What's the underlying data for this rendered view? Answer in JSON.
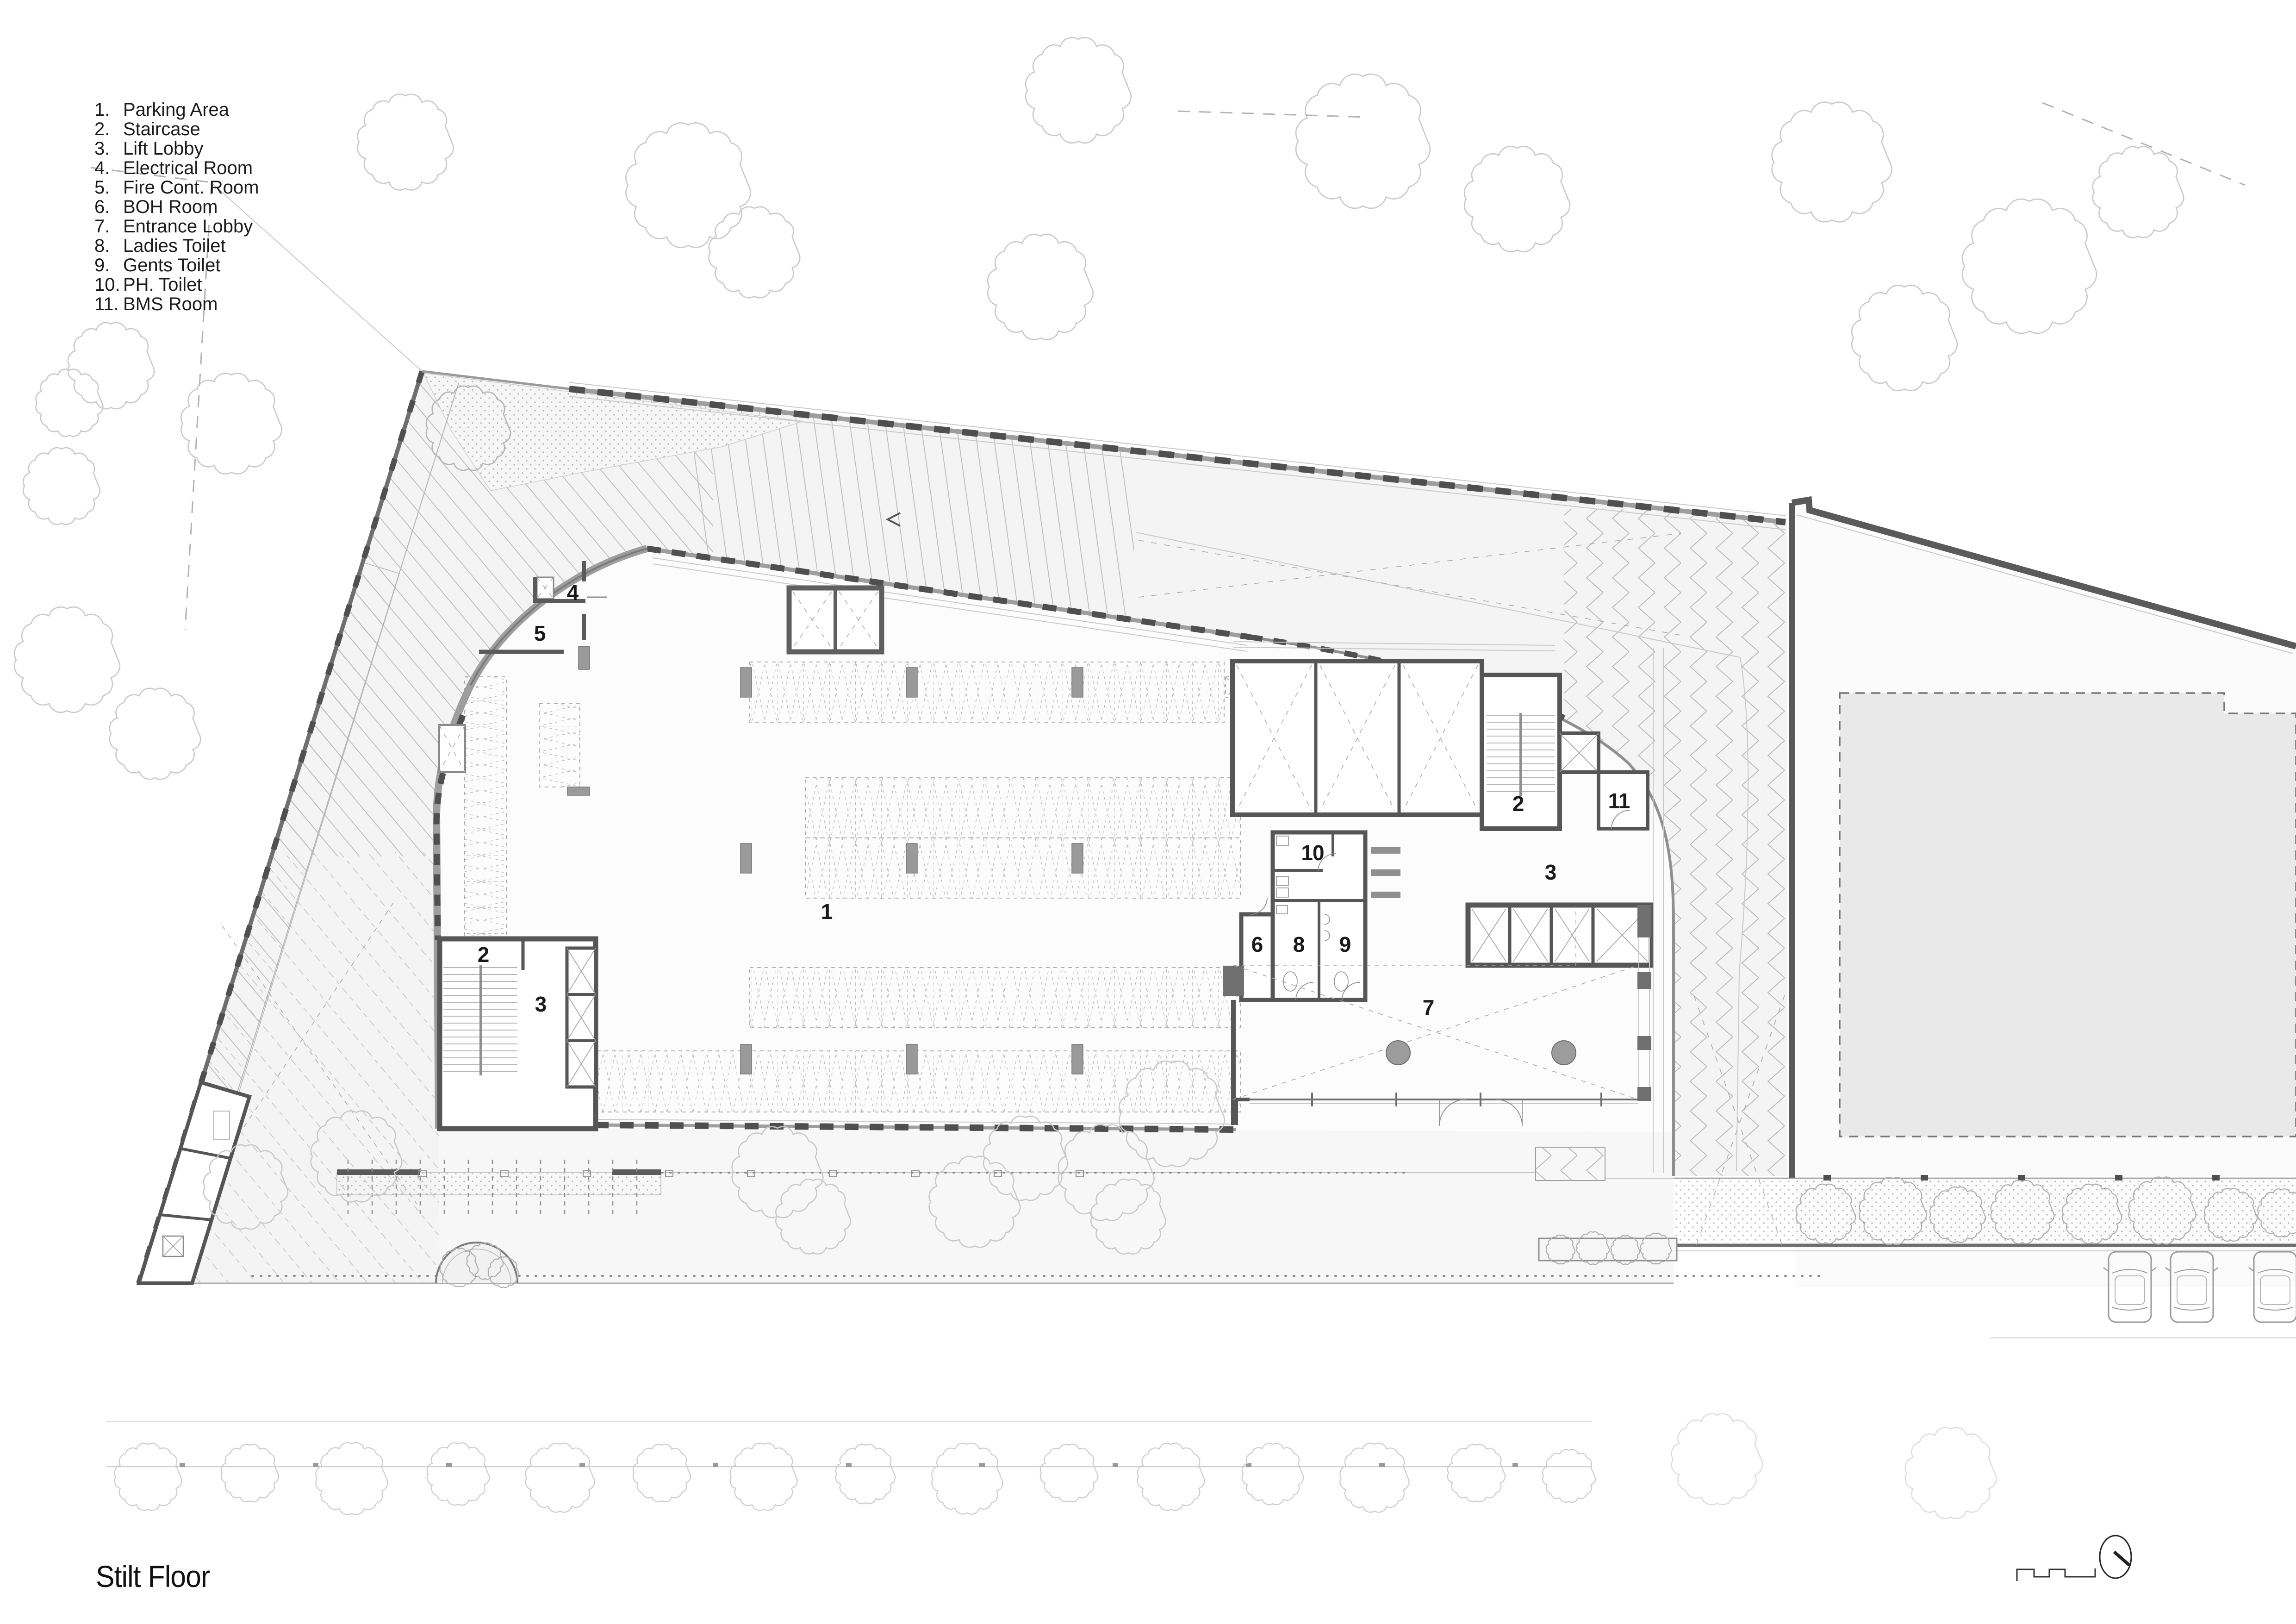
{
  "sheet": {
    "title": "Stilt Floor",
    "type_note": "architectural stilt-floor plan drawing"
  },
  "legend": {
    "items": [
      {
        "number": "1.",
        "label": "Parking Area"
      },
      {
        "number": "2.",
        "label": "Staircase"
      },
      {
        "number": "3.",
        "label": "Lift Lobby"
      },
      {
        "number": "4.",
        "label": "Electrical Room"
      },
      {
        "number": "5.",
        "label": "Fire Cont. Room"
      },
      {
        "number": "6.",
        "label": "BOH Room"
      },
      {
        "number": "7.",
        "label": "Entrance Lobby"
      },
      {
        "number": "8.",
        "label": "Ladies Toilet"
      },
      {
        "number": "9.",
        "label": "Gents Toilet"
      },
      {
        "number": "10.",
        "label": "PH. Toilet"
      },
      {
        "number": "11.",
        "label": "BMS Room"
      }
    ]
  },
  "plan_labels": {
    "parking": "1",
    "staircase_left": "2",
    "lift_lobby_left": "3",
    "electrical_room": "4",
    "fire_control_room": "5",
    "boh_room": "6",
    "entrance_lobby": "7",
    "ladies_toilet": "8",
    "gents_toilet": "9",
    "ph_toilet": "10",
    "bms_room": "11",
    "staircase_right": "2",
    "lift_lobby_right": "3"
  },
  "icons": {
    "north_indicator_icon": "ellipse-with-needle",
    "building_profile_icon": "crenellated-roof-outline"
  },
  "colors": {
    "wall_dark": "#4f4f4f",
    "wall_mid": "#9a9a9a",
    "hatch": "#bcbcbc",
    "site_fill": "#f7f7f7",
    "band_fill": "#f4f4f4",
    "neighbor_building_fill": "#e9e9e9",
    "text": "#1a1a1a"
  }
}
